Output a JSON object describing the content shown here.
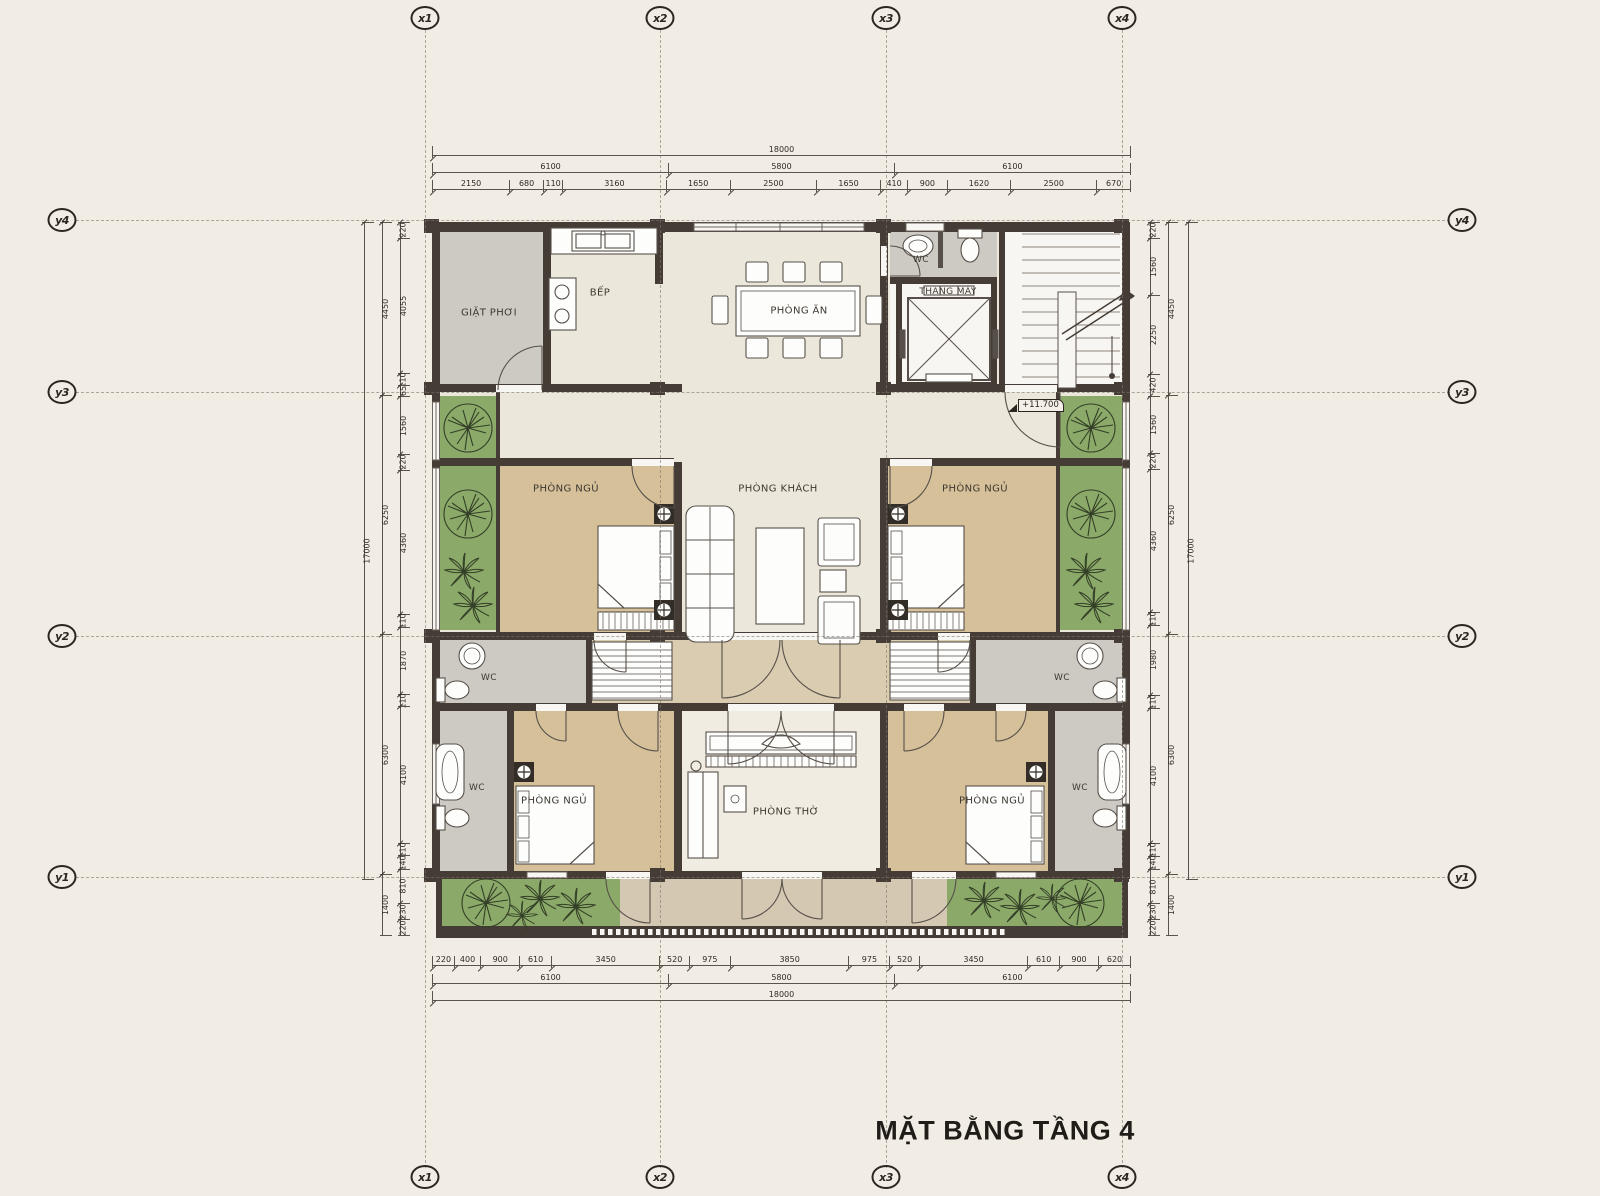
{
  "title": "MẶT BẰNG TẦNG 4",
  "level_annotation": "+11.700",
  "grid": {
    "x": [
      "x1",
      "x2",
      "x3",
      "x4"
    ],
    "y": [
      "y4",
      "y3",
      "y2",
      "y1"
    ]
  },
  "rooms": {
    "laundry": "GIẶT PHƠI",
    "kitchen": "BẾP",
    "dining": "PHÒNG ĂN",
    "wc": "WC",
    "elevator": "THANG MÁY",
    "bedroom": "PHÒNG NGỦ",
    "living": "PHÒNG KHÁCH",
    "worship": "PHÒNG THỜ"
  },
  "dimensions": {
    "top": {
      "total": [
        18000
      ],
      "mid": [
        6100,
        5800,
        6100
      ],
      "detail": [
        2150,
        680,
        110,
        3160,
        1650,
        2500,
        1650,
        410,
        900,
        1620,
        2500,
        670
      ]
    },
    "bottom": {
      "detail": [
        220,
        400,
        900,
        610,
        3450,
        520,
        975,
        3850,
        975,
        520,
        3450,
        610,
        900,
        620
      ],
      "mid": [
        6100,
        5800,
        6100
      ],
      "total": [
        18000
      ]
    },
    "left": {
      "total": [
        17000
      ],
      "outer": [
        4450,
        6250,
        6300,
        1400
      ],
      "detail": [
        220,
        4055,
        110,
        65,
        1560,
        220,
        4360,
        110,
        1870,
        110,
        4100,
        110,
        140,
        810,
        230,
        220
      ]
    },
    "right": {
      "total": [
        17000
      ],
      "outer": [
        4450,
        6250,
        6300,
        1400
      ],
      "detail": [
        220,
        1560,
        2250,
        420,
        1560,
        220,
        4360,
        110,
        1980,
        110,
        4100,
        110,
        140,
        810,
        230,
        220
      ]
    }
  },
  "colors": {
    "background": "#f1ece4",
    "wall": "#443c35",
    "bedroom_floor": "#d5c099",
    "wet_floor": "#cdc9c3",
    "planter_green": "#8ba968",
    "walkway": "#d4c8b2",
    "stairs_floor": "#f8f6f2",
    "ink": "#2c2620"
  }
}
